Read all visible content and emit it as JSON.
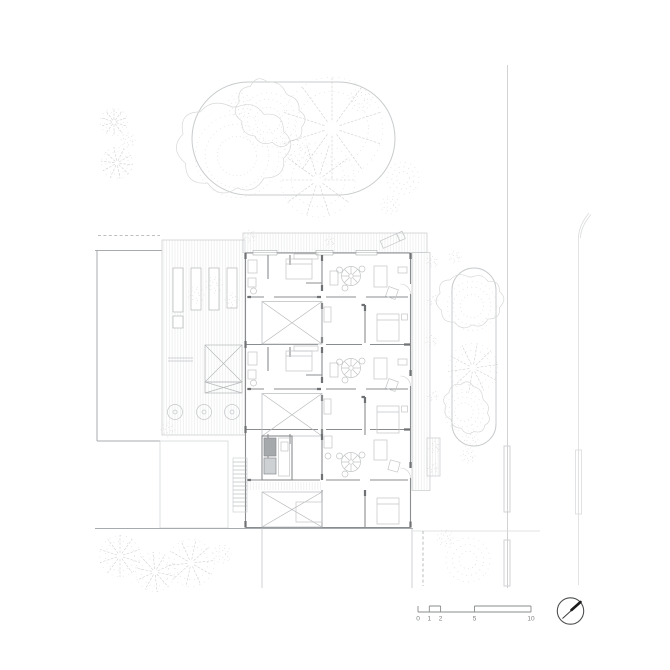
{
  "drawing": {
    "scale_bar": {
      "labels": [
        "0",
        "1",
        "2",
        "5",
        "10"
      ]
    },
    "north_arrow": {
      "icon": "north-arrow-icon"
    },
    "colors": {
      "outline": "#c8cbcd",
      "tree": "#d6d9d6",
      "treedark": "#cfd2cf",
      "hatch": "#e3e5e6",
      "wall": "#8a8d8f",
      "walldark": "#6f7274",
      "furn": "#c2c5c7",
      "xline": "#b6b9bb",
      "bound": "#a8abad",
      "road": "#ccced0",
      "roadlight": "#d9dbdc",
      "scale": "#8a8c8e",
      "text": "#7e8082",
      "needle": "#1b1b1b"
    }
  }
}
